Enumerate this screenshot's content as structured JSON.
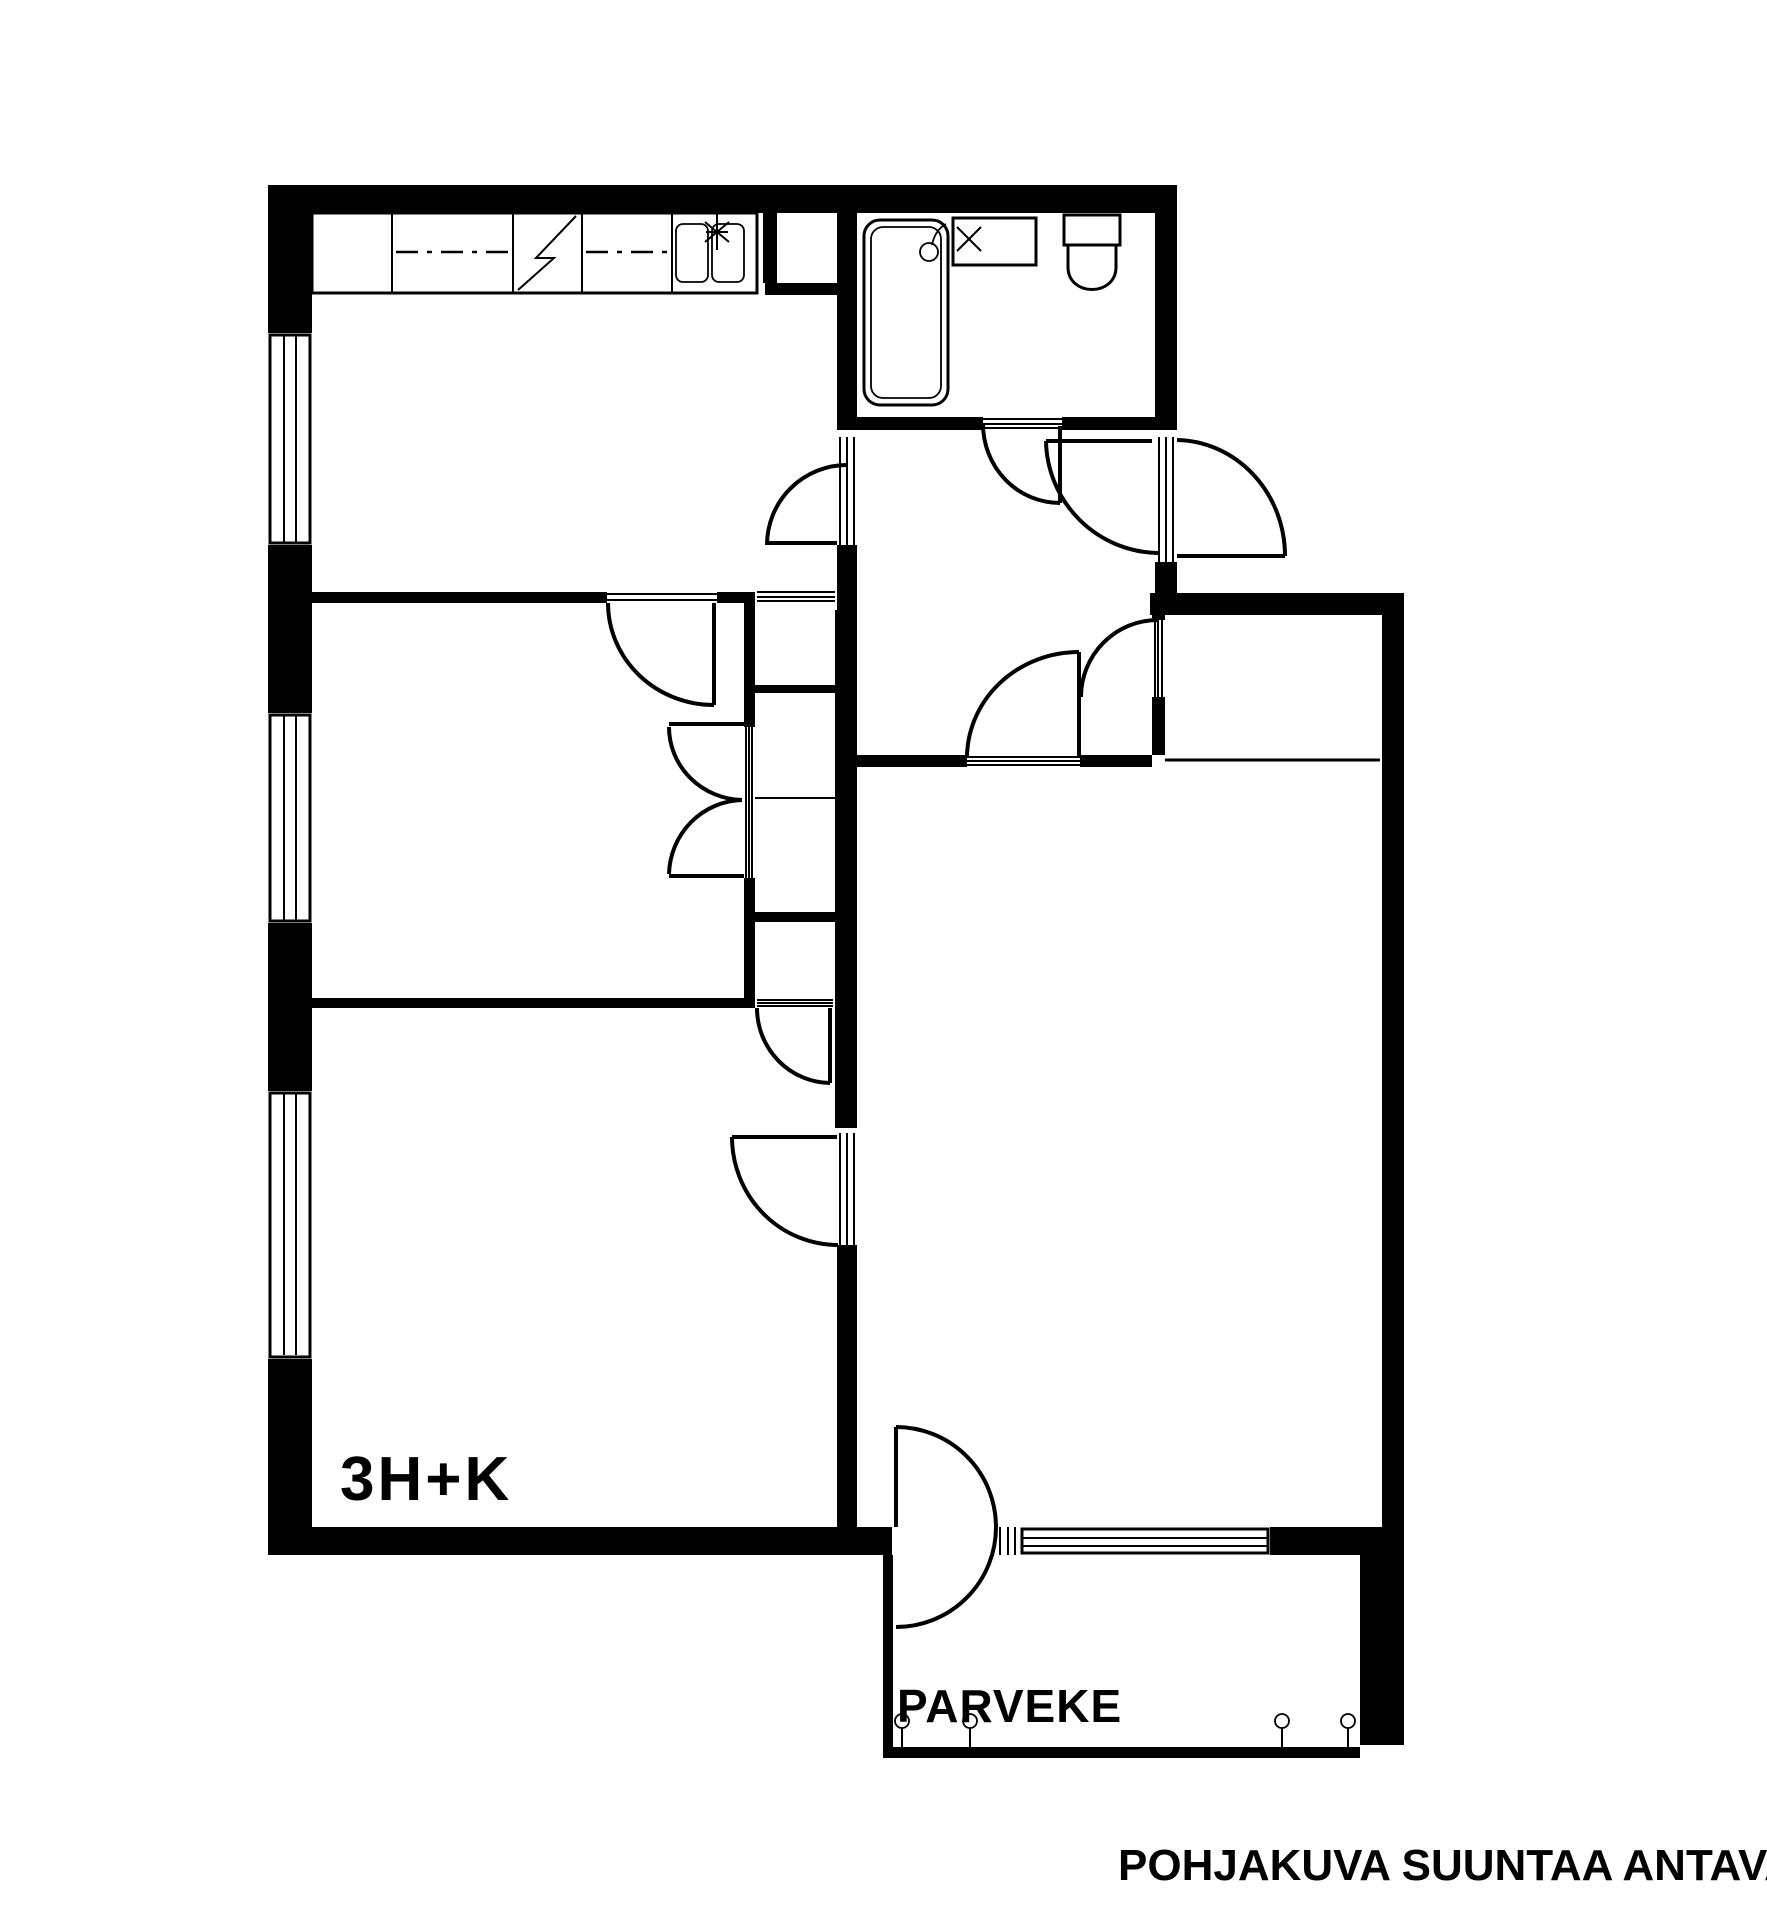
{
  "title": "Apartment floor plan",
  "labels": {
    "unit": "3H+K",
    "balcony": "PARVEKE",
    "disclaimer": "POHJAKUVA SUUNTAA ANTAVA"
  },
  "colors": {
    "line": "#000000",
    "background": "#ffffff"
  },
  "plan": {
    "rooms_visible_text": [
      "3H+K",
      "PARVEKE"
    ],
    "fixtures": [
      "kitchen-counter",
      "kitchen-stove",
      "kitchen-double-sink",
      "kitchen-faucet",
      "bathtub",
      "shower-head",
      "bathroom-sink",
      "toilet",
      "balcony-railing-posts",
      "windows",
      "interior-doors",
      "entrance-door",
      "balcony-door"
    ]
  }
}
